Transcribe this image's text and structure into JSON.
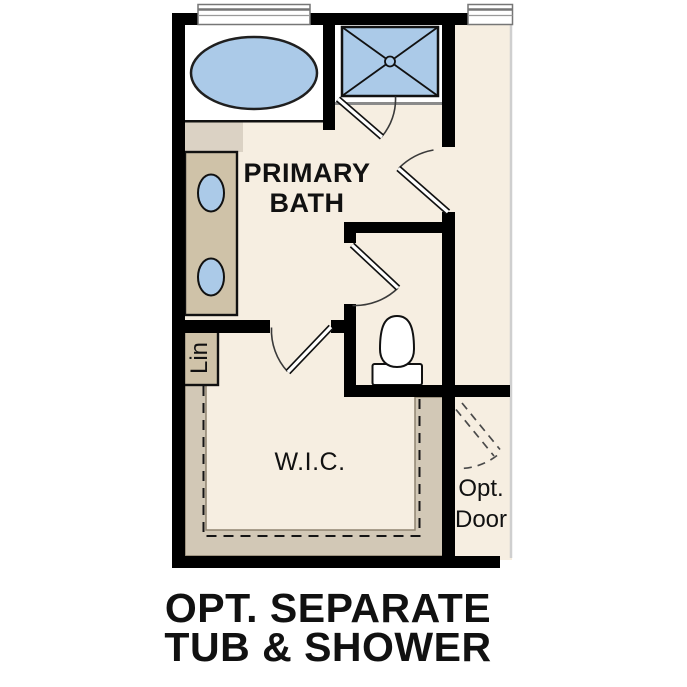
{
  "colors": {
    "wall": "#000000",
    "floor": "#f6eee1",
    "blue": "#abcae8",
    "tan": "#cfc2a8",
    "shelf": "#d2c8b6",
    "text": "#111111"
  },
  "labels": {
    "room_line1": "PRIMARY",
    "room_line2": "BATH",
    "wic": "W.I.C.",
    "lin": "Lin",
    "opt_door_line1": "Opt.",
    "opt_door_line2": "Door"
  },
  "caption": {
    "line1": "OPT. SEPARATE",
    "line2": "TUB & SHOWER"
  }
}
